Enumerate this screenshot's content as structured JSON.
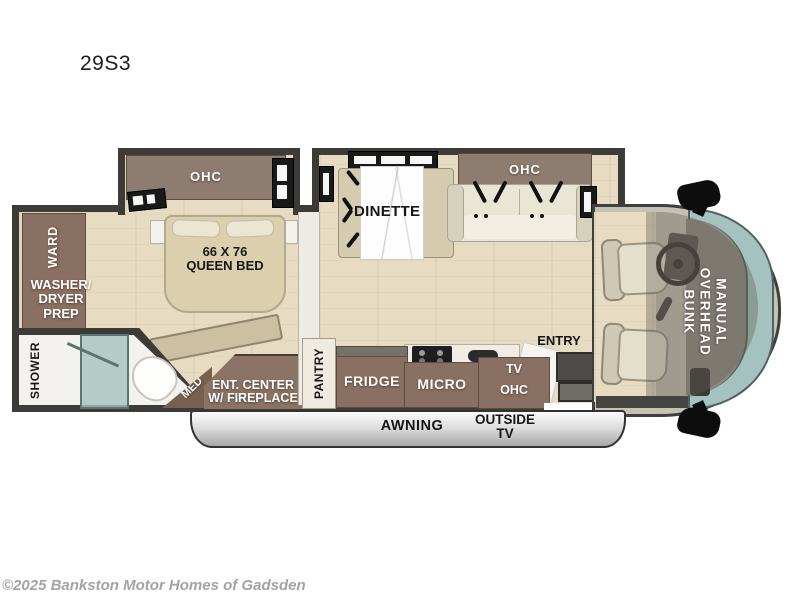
{
  "title": "29S3",
  "floorplan": {
    "bedroom": {
      "ohc_label": "OHC",
      "bed_label": "66 X 76\nQUEEN BED",
      "ward_label": "WARD",
      "washer_label": "WASHER/\nDRYER\nPREP",
      "shower_label": "SHOWER",
      "med_label": "MED",
      "ent_center_label": "ENT. CENTER\nW/ FIREPLACE"
    },
    "living": {
      "dinette_label": "DINETTE",
      "sofa_ohc_label": "OHC"
    },
    "kitchen": {
      "pantry_label": "PANTRY",
      "fridge_label": "FRIDGE",
      "micro_label": "MICRO",
      "tv_label": "TV",
      "tv_ohc_label": "OHC",
      "entry_label": "ENTRY"
    },
    "cab": {
      "bunk_label": "MANUAL\nOVERHEAD\nBUNK"
    },
    "exterior": {
      "awning_label": "AWNING",
      "outside_tv_label": "OUTSIDE\nTV"
    }
  },
  "footer": {
    "copyright": "©2025 Bankston Motor Homes of Gadsden"
  },
  "colors": {
    "wall": "#3d3b38",
    "floor_wood": "#e7dcc2",
    "cabinet_brown": "#8a7062",
    "cushion_cream": "#eae6d6",
    "windshield_glass": "#a5c3be",
    "awning_silver": "#c9c9c9",
    "copyright_gray": "#a3a3a3"
  }
}
